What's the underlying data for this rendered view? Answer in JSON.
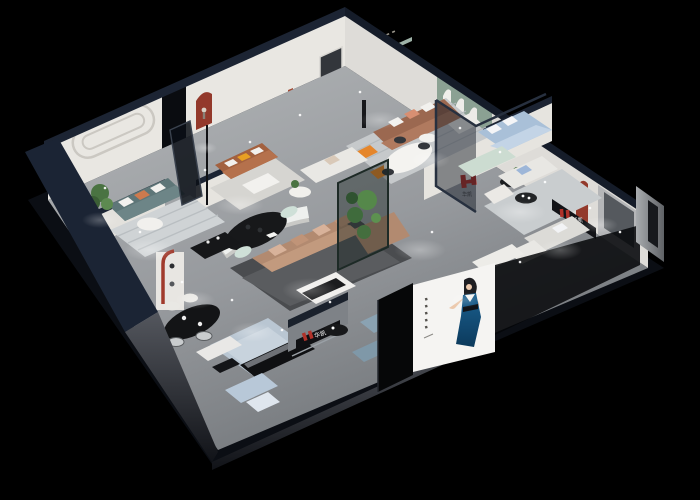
{
  "scene": {
    "type": "isometric-showroom-cutaway-render",
    "background": "#000000"
  },
  "brand": {
    "name": "华凯",
    "logo_color": "#b0322a"
  },
  "poster": {
    "background": "#f5f4f2",
    "subject": "woman-in-blue-dress",
    "dress_color": "#1a6090"
  },
  "palette": {
    "outer_wall_navy": "#1b2434",
    "wall_cap_navy": "#1c2433",
    "interior_wall": "#e9e7e2",
    "floor_gray": "#9aa0a5",
    "green_feature_wall": "#8ba193",
    "red_niche": "#93392b",
    "terracotta_sofa": "#a3613f",
    "tan_sectional": "#b28a70",
    "teal_sofa": "#5e7678",
    "light_blue_sofa": "#b8c8d8",
    "orange_accent": "#e5862b",
    "plant_green": "#4a7342"
  }
}
